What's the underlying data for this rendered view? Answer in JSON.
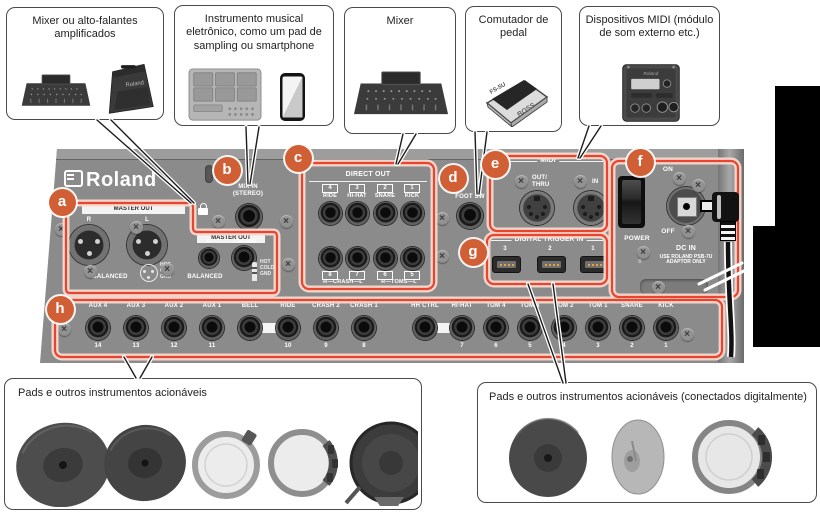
{
  "top_boxes": [
    {
      "label": "Mixer ou alto-falantes amplificados"
    },
    {
      "label": "Instrumento musical eletrônico, como um pad de sampling ou smartphone"
    },
    {
      "label": "Mixer"
    },
    {
      "label": "Comutador de pedal"
    },
    {
      "label": "Dispositivos MIDI (módulo de som externo etc.)"
    }
  ],
  "bottom_boxes": [
    {
      "label": "Pads e outros instrumentos acionáveis"
    },
    {
      "label": "Pads e outros instrumentos acionáveis (conectados digitalmente)"
    }
  ],
  "panel": {
    "brand": "Roland",
    "callouts": {
      "a": "a",
      "b": "b",
      "c": "c",
      "d": "d",
      "e": "e",
      "f": "f",
      "g": "g",
      "h": "h"
    },
    "master_out_xlr": {
      "header": "MASTER OUT",
      "left_jack": "R",
      "right_jack": "L",
      "balanced": "BALANCED",
      "pins": [
        "HOT",
        "COLD",
        "GND"
      ]
    },
    "master_out_trs": {
      "header": "MASTER OUT",
      "left_jack": "R",
      "right_jack": "L/MONO",
      "balanced": "BALANCED",
      "pins": [
        "HOT",
        "COLD",
        "GND"
      ]
    },
    "mix_in": {
      "line1": "MIX IN",
      "line2": "(STEREO)"
    },
    "direct_out": {
      "header": "DIRECT OUT",
      "top": [
        {
          "num": "4",
          "name": "RIDE"
        },
        {
          "num": "3",
          "name": "HI-HAT"
        },
        {
          "num": "2",
          "name": "SNARE"
        },
        {
          "num": "1",
          "name": "KICK"
        }
      ],
      "bottom": [
        "8",
        "7",
        "6",
        "5"
      ],
      "groups": [
        "R—CRASH—L",
        "R—TOMS—L"
      ]
    },
    "foot_sw": "FOOT SW",
    "midi": {
      "header": "MIDI",
      "jack1_line1": "OUT/",
      "jack1_line2": "THRU",
      "jack2": "IN"
    },
    "digital_trigger": {
      "header": "DIGITAL TRIGGER IN",
      "ports": [
        "3",
        "2",
        "1"
      ]
    },
    "power": {
      "on": "ON",
      "off": "OFF",
      "label": "POWER",
      "dc_in": "DC IN",
      "note1": "USE ROLAND PSB-7U",
      "note2": "ADAPTOR ONLY"
    },
    "triggers": [
      {
        "name": "AUX 4",
        "num": "14"
      },
      {
        "name": "AUX 3",
        "num": "13"
      },
      {
        "name": "AUX 2",
        "num": "12"
      },
      {
        "name": "AUX 1",
        "num": "11"
      },
      {
        "name": "BELL",
        "num": ""
      },
      {
        "name": "RIDE",
        "num": "10"
      },
      {
        "name": "CRASH 2",
        "num": "9"
      },
      {
        "name": "CRASH 1",
        "num": "8"
      },
      {
        "name": "HH CTRL",
        "num": ""
      },
      {
        "name": "HI-HAT",
        "num": "7"
      },
      {
        "name": "TOM 4",
        "num": "6"
      },
      {
        "name": "TOM 3",
        "num": "5"
      },
      {
        "name": "TOM 2",
        "num": "4"
      },
      {
        "name": "TOM 1",
        "num": "3"
      },
      {
        "name": "SNARE",
        "num": "2"
      },
      {
        "name": "KICK",
        "num": "1"
      }
    ]
  },
  "colors": {
    "accent_red": "#e8452e",
    "halo_pink": "#f8d8cf",
    "callout_orange": "#d15f35",
    "panel_gray": "#8b8b8b"
  }
}
